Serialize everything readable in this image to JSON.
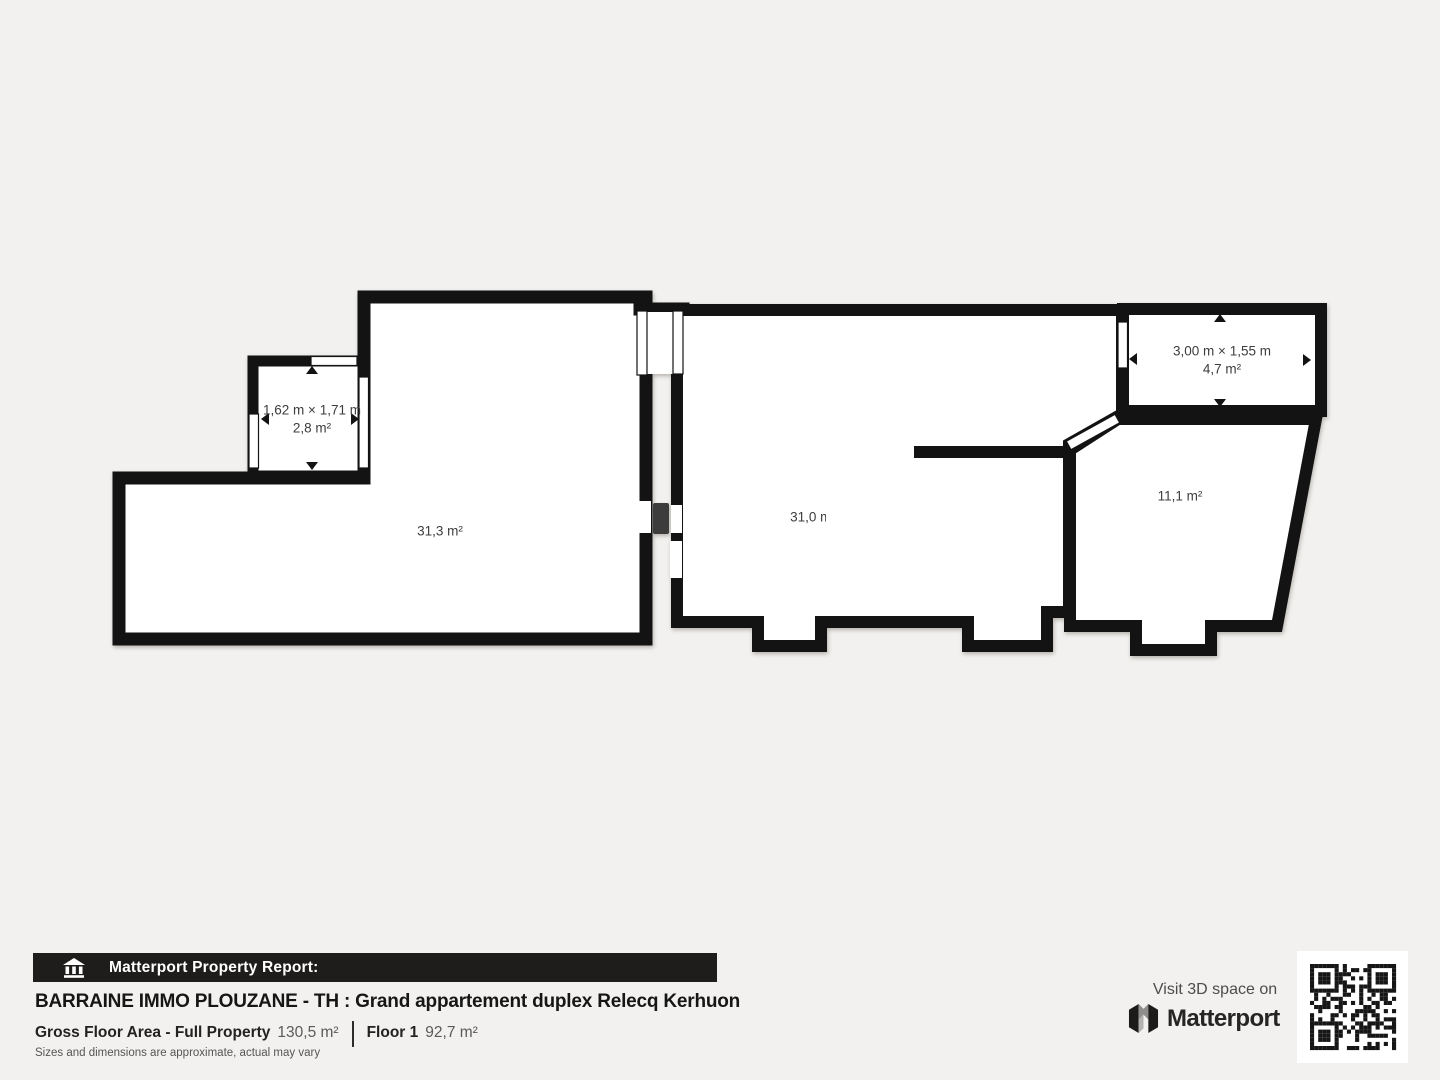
{
  "plan": {
    "rooms": [
      {
        "id": "closet",
        "dimensions": "1,62 m × 1,71 m",
        "area": "2,8 m²"
      },
      {
        "id": "living-left",
        "area": "31,3 m²"
      },
      {
        "id": "living-mid",
        "area": "31,0 m²"
      },
      {
        "id": "balcony",
        "dimensions": "3,00 m × 1,55 m",
        "area": "4,7 m²"
      },
      {
        "id": "bedroom-right",
        "area": "11,1 m²"
      }
    ],
    "icons": [
      "measure-arrow-icon",
      "window-marker",
      "door-swing-marker"
    ]
  },
  "footer": {
    "report_bar": {
      "label": "Matterport Property Report:",
      "icon": "building-columns-icon"
    },
    "title": "BARRAINE IMMO PLOUZANE - TH : Grand appartement duplex Relecq Kerhuon",
    "stats": {
      "gross_label": "Gross Floor Area - Full Property",
      "gross_value": "130,5 m²",
      "floor_label": "Floor 1",
      "floor_value": "92,7 m²"
    },
    "disclaimer": "Sizes and dimensions are approximate, actual may vary",
    "cta": {
      "visit_text": "Visit 3D space on",
      "brand": "Matterport",
      "icons": [
        "matterport-logo-icon",
        "qr-code"
      ]
    }
  },
  "colors": {
    "background": "#f2f1ef",
    "wall": "#131313",
    "floor": "#ffffff",
    "label": "#3d3d3d",
    "bar": "#1f1d1b"
  }
}
